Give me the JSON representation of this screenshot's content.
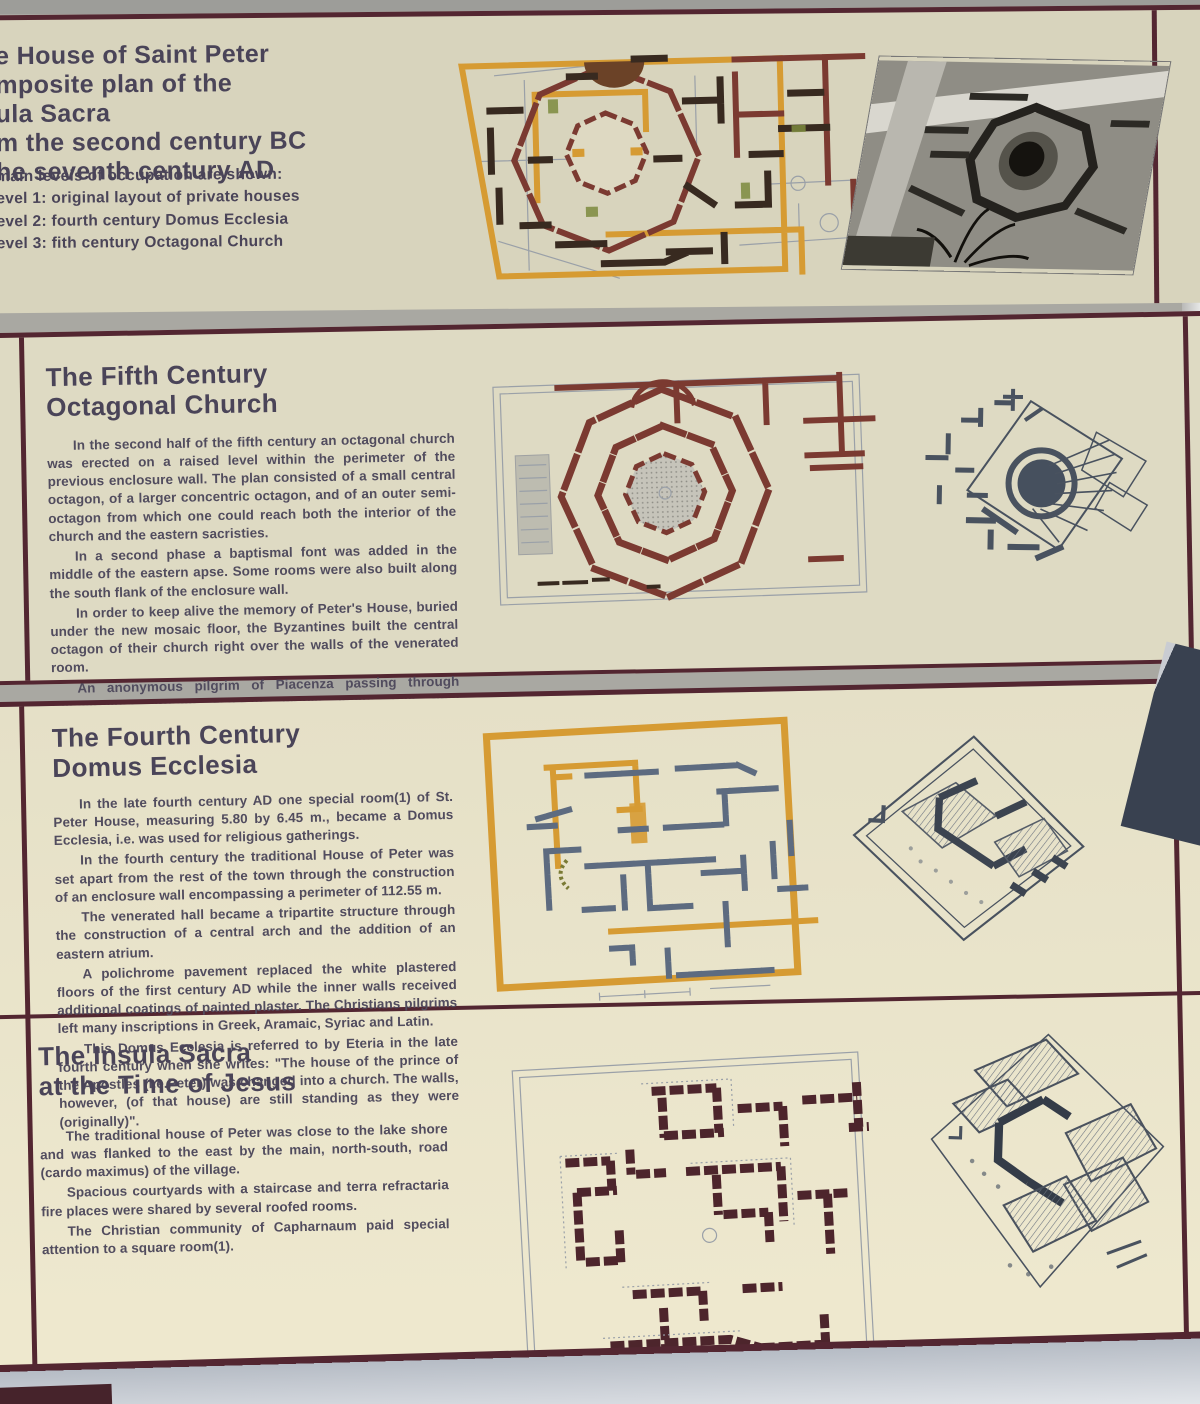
{
  "palette": {
    "bg_gray": "#a9a8a2",
    "strip_light": "#c9c7bf",
    "cream_top": "#d8d4bd",
    "cream_mid": "#dedac3",
    "cream_low": "#e5e0c7",
    "cream_bottom": "#efe9cf",
    "maroon": "#532631",
    "ink_title": "#4a4458",
    "ink_body": "#514c5e",
    "orange": "#d69b33",
    "wall_dark": "#382a20",
    "wall_maroon": "#7b3a31",
    "wall_stone": "#5d6b80",
    "sketch_ink": "#49525f",
    "metal_dark": "#394150",
    "metal_light": "#e6e7e6",
    "sill_light": "#eef0f3"
  },
  "panel_top": {
    "title_lines": [
      "e House of Saint Peter",
      "mposite plan of the",
      "ula Sacra",
      "m the second century BC",
      "he seventh century AD"
    ],
    "levels_intro": "main leveis of occupation are shown:",
    "levels": [
      "evel 1: original layout of private houses",
      "evel 2: fourth century Domus Ecclesia",
      "evel 3: fith century Octagonal Church"
    ]
  },
  "panel_fifth": {
    "title_lines": [
      "The Fifth Century",
      "Octagonal Church"
    ],
    "paragraphs": [
      "In the second half of the fifth century an octagonal church was erected on a raised level within the perimeter of the previous enclosure wall. The plan consisted of a small central octagon, of a larger concentric octagon, and of an outer semi-octagon from which one could reach both the interior of the church and the eastern sacristies.",
      "In a second phase a baptismal font was added in the middle of the eastern apse. Some rooms were also built along the south flank of the enclosure wall.",
      "In order to keep alive the memory of Peter's House, buried under the new mosaic floor, the Byzantines built the central octagon of their church right over the walls of the venerated room.",
      "An anonymous pilgrim of Piacenza passing through Capharnaum around 560-570, writes about this final transformation.",
      "\"And so we came on to Capharnaum to the house of Saint Peter, which is now a basilica\". Probably the church was destroyed during the Persian invasion in the early seventh century.",
      "Several Middle Ages structures were built in the area of the abandoned church. The modern Memorial upon the House of Saint Peter was dedicated on June 29 1990."
    ]
  },
  "panel_fourth": {
    "title_lines": [
      "The Fourth Century",
      "Domus Ecclesia"
    ],
    "paragraphs": [
      "In the late fourth century AD one special room(1) of St. Peter House, measuring 5.80 by 6.45 m., became a Domus Ecclesia, i.e. was used for religious gatherings.",
      "In the fourth century the traditional House of Peter was set apart from the rest of the town through the construction of an enclosure wall encompassing a perimeter of 112.55 m.",
      "The venerated hall became a tripartite structure through the construction of a central arch and the addition of an eastern atrium.",
      "A polichrome pavement replaced the white plastered floors of the first century AD while the inner walls received additional coatings of painted plaster. The Christians pilgrims left many inscriptions in Greek, Aramaic, Syriac and Latin.",
      "This Domus Ecclesia is referred to by Eteria in the late fourth century when she writes: \"The house of the prince of the Apostles (i.e.Peter) was changed into a church. The walls, however, (of that house) are still standing as they were (originally)\"."
    ]
  },
  "panel_insula": {
    "title_lines": [
      "The Insula Sacra",
      "at the Time of Jesus"
    ],
    "paragraphs": [
      "The traditional house of Peter was close to the lake shore and was flanked to the east by the main, north-south, road (cardo maximus) of the village.",
      "Spacious courtyards with a staircase and terra refractaria fire places were shared by several roofed rooms.",
      "The Christian community of Capharnaum paid special attention to a square room(1)."
    ]
  }
}
